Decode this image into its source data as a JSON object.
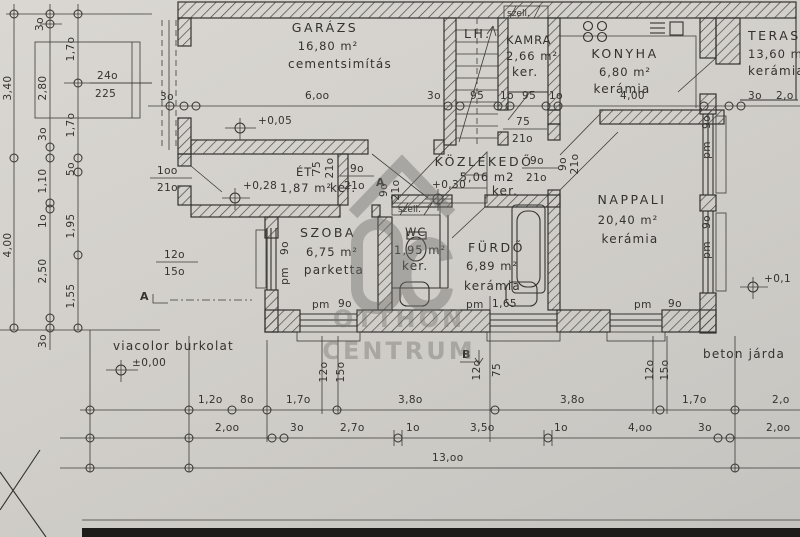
{
  "watermark": {
    "brand_line1": "OTTHON",
    "brand_line2": "CENTRUM"
  },
  "rooms": {
    "garazs": {
      "name": "GARÁZS",
      "area": "16,80 m²",
      "finish": "cementsimítás"
    },
    "lh": {
      "name": "LH."
    },
    "kamra": {
      "name": "KAMRA",
      "area": "2,66 m²",
      "finish": "ker.",
      "vent": "szell."
    },
    "konyha": {
      "name": "KONYHA",
      "area": "6,80 m²",
      "finish": "kerámia",
      "width": "4,00"
    },
    "terasz": {
      "name": "TERASZ",
      "area": "13,60 m²",
      "finish": "kerámia"
    },
    "kozlekedo": {
      "name": "KÖZLEKEDŐ",
      "area": "5,06 m2",
      "finish": "ker."
    },
    "etkezo": {
      "name": "ÉT.",
      "area": "1,87 m²",
      "finish": "ker."
    },
    "szoba": {
      "name": "SZOBA",
      "area": "6,75 m²",
      "finish": "parketta"
    },
    "wc": {
      "name": "WC",
      "area": "1,95 m²",
      "finish": "ker.",
      "vent": "szell."
    },
    "furdo": {
      "name": "FÜRDŐ",
      "area": "6,89 m²",
      "finish": "kerámia"
    },
    "nappali": {
      "name": "NAPPALI",
      "area": "20,40 m²",
      "finish": "kerámia"
    }
  },
  "levels": {
    "zero": "±0,00",
    "garage": "+0,05",
    "entry": "+0,28",
    "hall": "+0,30",
    "terrace": "+0,1"
  },
  "labels": {
    "paving_left": "viacolor burkolat",
    "paving_right": "beton járda"
  },
  "sections": {
    "a": "A",
    "a2": "A",
    "b": "B"
  },
  "doors": {
    "garage": {
      "w": "24o",
      "h": "225"
    },
    "entry": {
      "w": "1oo",
      "h": "21o"
    },
    "stair": {
      "w": "75",
      "h": "21o"
    },
    "et": {
      "w": "9o",
      "h": "21o"
    },
    "konyha": {
      "w": "9o",
      "h": "21o"
    },
    "szoba_v": {
      "w": "75",
      "h": "21o"
    },
    "wc_v": {
      "w": "9o",
      "h": "21o"
    },
    "nappali_v": {
      "w": "9o",
      "h": "21o"
    }
  },
  "windows": {
    "szoba_left": {
      "fr_w": "12o",
      "fr_h": "15o",
      "pm": "pm",
      "sill": "9o"
    },
    "szoba_bottom": {
      "pm": "pm",
      "sill": "9o",
      "v1": "12o",
      "v2": "15o"
    },
    "furdo_bottom": {
      "pm": "pm",
      "sill": "1,65",
      "v1": "12o",
      "v2": "75"
    },
    "nappali_bottom": {
      "pm": "pm",
      "sill": "9o",
      "v1": "12o",
      "v2": "15o"
    },
    "nappali_right1": {
      "pm": "pm",
      "sill": "9o"
    },
    "nappali_right2": {
      "pm": "pm",
      "sill": "9o"
    }
  },
  "dims": {
    "top_30_rot": "3o",
    "left_340": "3,40",
    "left_400": "4,00",
    "left_280": "2,80",
    "left_30_mid": "3o",
    "left_110": "1,10",
    "left_10": "1o",
    "left_250": "2,50",
    "left_30_bottom": "3o",
    "left_170_top": "1,7o",
    "left_170_mid": "1,7o",
    "left_50": "5o",
    "left_195": "1,95",
    "left_155": "1,55",
    "garage_wall_left": "3o",
    "garage_width": "6,oo",
    "garage_wall_right": "3o",
    "stair_95a": "95",
    "stair_10a": "1o",
    "stair_95b": "95",
    "stair_10b": "1o",
    "konyha_width": "4,00",
    "terasz_30": "3o",
    "terasz_20": "2,o",
    "row1": [
      "1,2o",
      "8o",
      "1,7o",
      "3,8o",
      "3,8o",
      "1,7o",
      "2,o"
    ],
    "row2": [
      "2,oo",
      "3o",
      "2,7o",
      "1o",
      "3,5o",
      "1o",
      "4,oo",
      "3o",
      "2,oo"
    ],
    "row3_total": "13,oo"
  }
}
